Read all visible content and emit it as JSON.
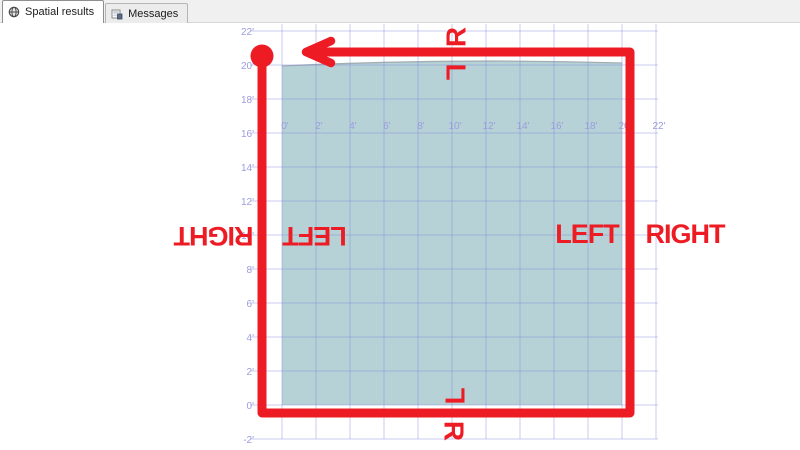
{
  "window": {
    "tabs": [
      {
        "label": "Spatial results",
        "icon": "globe-icon",
        "active": true
      },
      {
        "label": "Messages",
        "icon": "messages-icon",
        "active": false
      }
    ]
  },
  "colors": {
    "accent_red": "#ed1c24",
    "grid_line": "#7c86d8",
    "grid_label": "#9c9cdf",
    "polygon_fill": "#b7d2d7",
    "polygon_stroke": "#a3aeb3",
    "tabbar_bg": "#f0f0f0"
  },
  "chart_data": {
    "type": "spatial-plot",
    "title": "Spatial results viewer: square polygon with directed ring path and LEFT/RIGHT side annotations",
    "x_axis": {
      "unit": "feet",
      "range": [
        0,
        22
      ],
      "tick_labels": [
        "0'",
        "2'",
        "4'",
        "6'",
        "8'",
        "10'",
        "12'",
        "14'",
        "16'",
        "18'",
        "20'",
        "22'"
      ]
    },
    "y_axis": {
      "unit": "feet",
      "range": [
        -2,
        22
      ],
      "tick_labels": [
        "22'",
        "20'",
        "18'",
        "16'",
        "14'",
        "12'",
        "10'",
        "8'",
        "6'",
        "4'",
        "2'",
        "0'",
        "-2'"
      ]
    },
    "polygon": {
      "shape": "square",
      "x_range_ft": [
        0,
        20
      ],
      "y_range_ft": [
        0,
        20
      ]
    },
    "ring_path": {
      "start_marker": "dot",
      "end_marker": "arrow-left",
      "route": "start top-left, down left side, right along bottom, up right side, left along top to arrow"
    },
    "annotations": {
      "top_outside": "R",
      "top_inside": "L",
      "bottom_inside": "L",
      "bottom_outside": "R",
      "left_outside": "RIGHT",
      "left_inside": "LEFT",
      "right_inside": "LEFT",
      "right_outside": "RIGHT"
    }
  }
}
